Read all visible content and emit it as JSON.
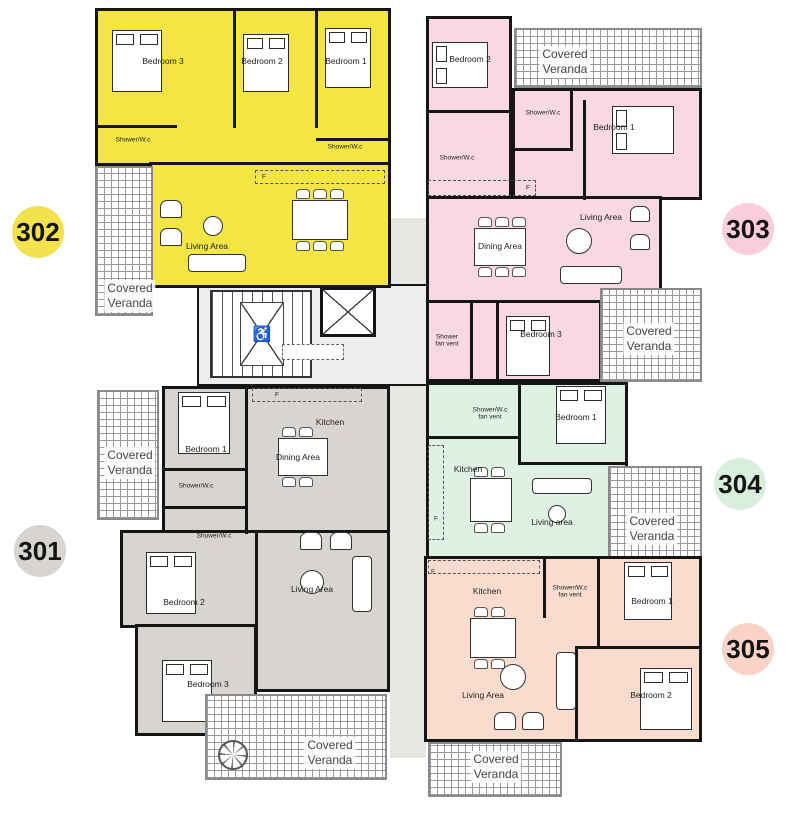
{
  "colors": {
    "wall": "#151515",
    "u301_fill": "#d8d4d0",
    "u302_fill": "#f2e544",
    "u303_fill": "#f8d8e2",
    "u304_fill": "#def1e2",
    "u305_fill": "#fadcce"
  },
  "core": {
    "wheelchair_icon": "♿"
  },
  "units": {
    "u302": {
      "badge": "302",
      "rooms": {
        "bedroom3": "Bedroom 3",
        "bedroom2": "Bedroom 2",
        "bedroom1": "Bedroom 1",
        "shower_a": "Shower/W.c",
        "shower_b": "Shower/W.c",
        "living": "Living Area",
        "fridge": "F",
        "veranda": "Covered\nVeranda"
      }
    },
    "u303": {
      "badge": "303",
      "rooms": {
        "bedroom2": "Bedroom 2",
        "bedroom1": "Bedroom 1",
        "bedroom3": "Bedroom 3",
        "shower_a": "Shower/W.c",
        "shower_b": "Shower/W.c",
        "shower_c": "Shower\nfan vent",
        "dining": "Dining Area",
        "living": "Living Area",
        "fridge": "F",
        "veranda_top": "Covered\nVeranda",
        "veranda_bottom": "Covered\nVeranda"
      }
    },
    "u304": {
      "badge": "304",
      "rooms": {
        "bedroom1": "Bedroom 1",
        "shower": "Shower/W.c\nfan vent",
        "kitchen": "Kitchen",
        "living": "Living area",
        "fridge": "F",
        "veranda": "Covered\nVeranda"
      }
    },
    "u301": {
      "badge": "301",
      "rooms": {
        "bedroom1": "Bedroom 1",
        "bedroom2": "Bedroom 2",
        "bedroom3": "Bedroom 3",
        "kitchen": "Kitchen",
        "dining": "Dining Area",
        "living": "Living Area",
        "shower_a": "Shower/W.c",
        "shower_b": "Shower/W.c",
        "fridge": "F",
        "veranda_left": "Covered\nVeranda",
        "veranda_bottom": "Covered\nVeranda"
      }
    },
    "u305": {
      "badge": "305",
      "rooms": {
        "bedroom1": "Bedroom 1",
        "bedroom2": "Bedroom 2",
        "kitchen": "Kitchen",
        "living": "Living Area",
        "shower": "Shower/W.c\nfan vent",
        "fridge": "F",
        "veranda": "Covered\nVeranda"
      }
    }
  }
}
